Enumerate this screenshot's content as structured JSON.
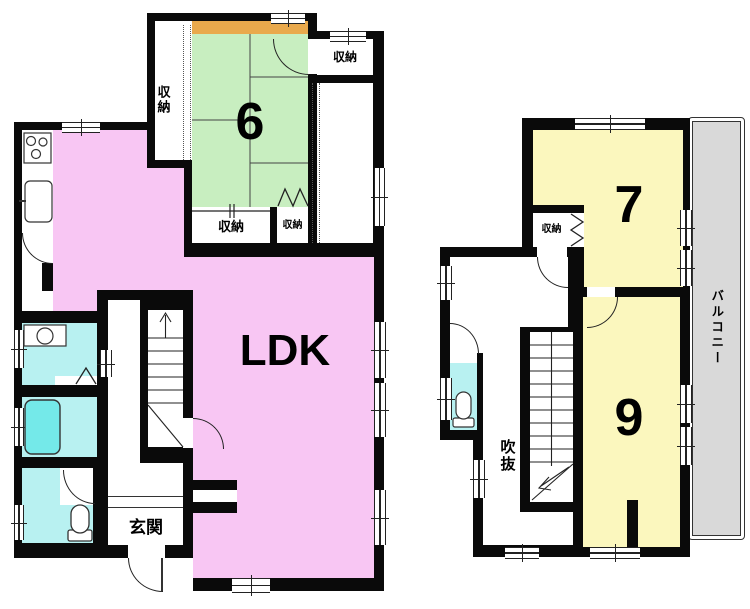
{
  "colors": {
    "wall": "#0a0a0a",
    "line": "#222222",
    "ldk_pink": "#f8c6f3",
    "tatami_green": "#c8eec0",
    "room_yellow": "#fbf7be",
    "wet_cyan": "#b8f1f1",
    "tub_cyan": "#74e9e9",
    "closet_orange": "#e9a94c",
    "balcony_gray": "#d9d9d9"
  },
  "floor1": {
    "rooms": {
      "ldk": {
        "label": "LDK"
      },
      "tatami6": {
        "label": "6"
      },
      "closet_left": {
        "label": "収納"
      },
      "closet_top_right": {
        "label": "収納"
      },
      "closet_bottom_left": {
        "label": "収納"
      },
      "closet_bottom_right": {
        "label": "収納"
      },
      "entrance": {
        "label": "玄関"
      }
    }
  },
  "floor2": {
    "rooms": {
      "room7": {
        "label": "7"
      },
      "room9": {
        "label": "9"
      },
      "closet": {
        "label": "収納"
      },
      "void_label": {
        "label": "吹抜"
      },
      "balcony": {
        "label": "バルコニー"
      }
    }
  }
}
